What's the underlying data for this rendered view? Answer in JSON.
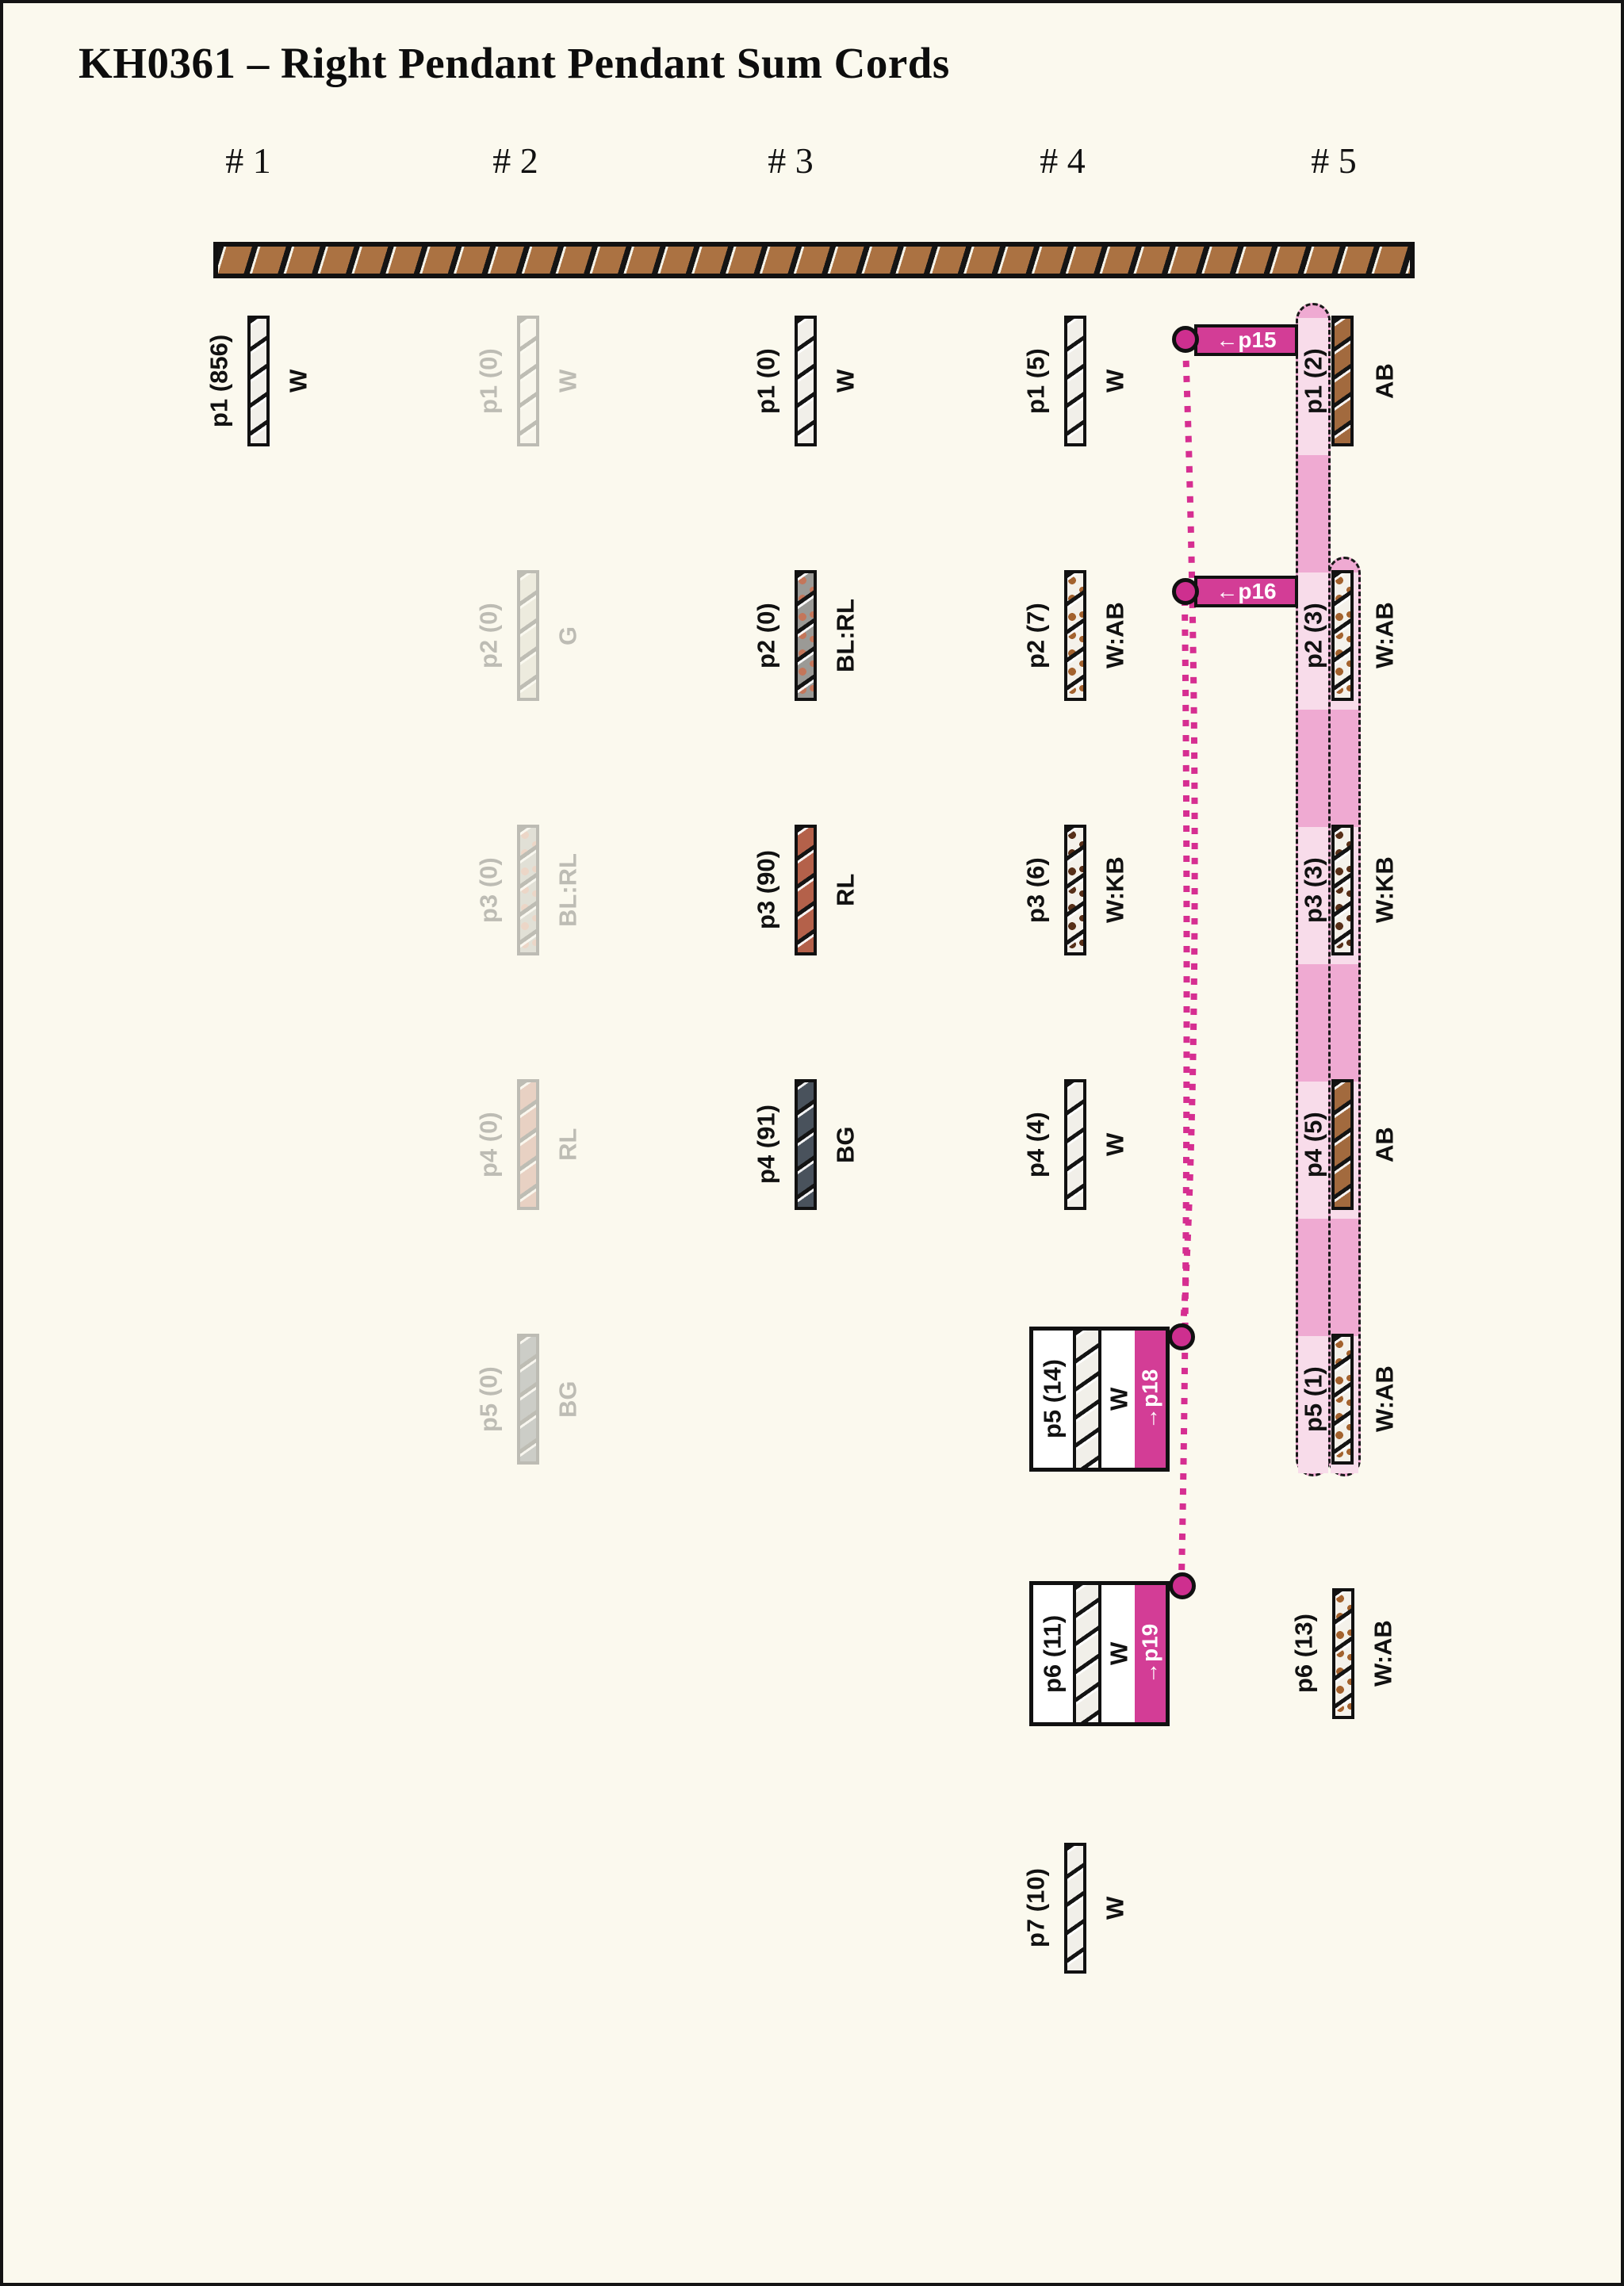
{
  "title": "KH0361 – Right Pendant Pendant Sum Cords",
  "columns": [
    {
      "header": "# 1",
      "pendants": [
        {
          "label": "p1 (856)",
          "code": "W"
        }
      ]
    },
    {
      "header": "# 2",
      "pendants": [
        {
          "label": "p1 (0)",
          "code": "W"
        },
        {
          "label": "p2 (0)",
          "code": "G"
        },
        {
          "label": "p3 (0)",
          "code": "BL:RL"
        },
        {
          "label": "p4 (0)",
          "code": "RL"
        },
        {
          "label": "p5 (0)",
          "code": "BG"
        }
      ]
    },
    {
      "header": "# 3",
      "pendants": [
        {
          "label": "p1 (0)",
          "code": "W"
        },
        {
          "label": "p2 (0)",
          "code": "BL:RL"
        },
        {
          "label": "p3 (90)",
          "code": "RL"
        },
        {
          "label": "p4 (91)",
          "code": "BG"
        }
      ]
    },
    {
      "header": "# 4",
      "pendants": [
        {
          "label": "p1 (5)",
          "code": "W"
        },
        {
          "label": "p2 (7)",
          "code": "W:AB"
        },
        {
          "label": "p3 (6)",
          "code": "W:KB"
        },
        {
          "label": "p4 (4)",
          "code": "W"
        },
        {
          "label": "p5 (14)",
          "code": "W"
        },
        {
          "label": "p6 (11)",
          "code": "W"
        },
        {
          "label": "p7 (10)",
          "code": "W"
        }
      ]
    },
    {
      "header": "# 5",
      "pendants": [
        {
          "label": "p1 (2)",
          "code": "AB"
        },
        {
          "label": "p2 (3)",
          "code": "W:AB"
        },
        {
          "label": "p3 (3)",
          "code": "W:KB"
        },
        {
          "label": "p4 (5)",
          "code": "AB"
        },
        {
          "label": "p5 (1)",
          "code": "W:AB"
        },
        {
          "label": "p6 (13)",
          "code": "W:AB"
        }
      ]
    }
  ],
  "markers": {
    "p15": "←p15",
    "p16": "←p16",
    "p18": "→p18",
    "p19": "→p19"
  },
  "colors": {
    "background": "#fbf9ee",
    "primary_cord_brown": "#ab7242",
    "marker_magenta": "#d33d96",
    "dotted_line_magenta": "#d62e91",
    "band_light_pink": "#f8dcea",
    "band_dark_pink": "#efaad2",
    "W": "#f1efe9",
    "AB": "#a26a3e",
    "RL": "#b4614a",
    "BG": "#49525c",
    "G": "#c6c6b2",
    "BL_RL": "#9b9a96",
    "speckle_AB": "#a3622e",
    "speckle_KB": "#572f18"
  }
}
